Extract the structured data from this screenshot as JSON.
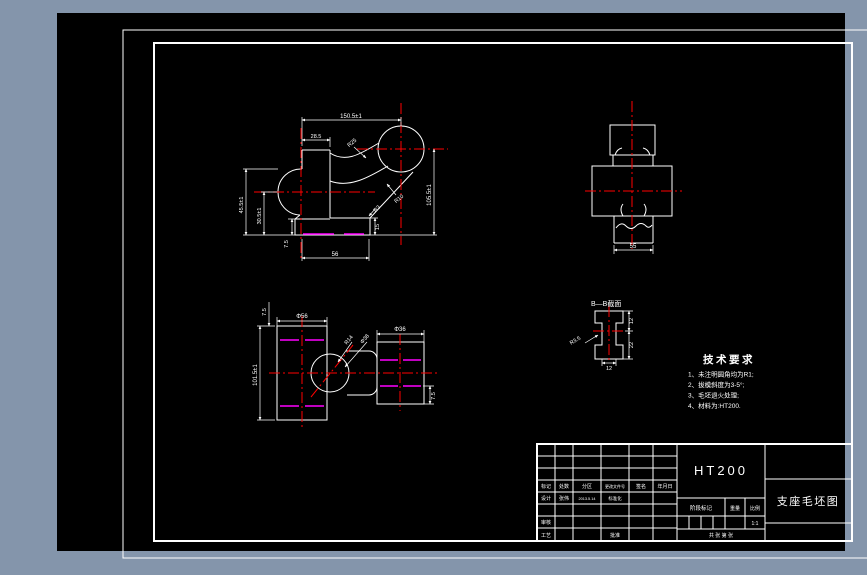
{
  "window": {
    "background_color": "#8495ab",
    "canvas_color": "#000000",
    "line_color": "#ffffff",
    "centerline_color": "#ff0000",
    "parting_line_color": "#ff00ff"
  },
  "front_view": {
    "dim_top": "150.5±1",
    "dim_neck": "28.5",
    "dim_left_outer": "45.5±1",
    "dim_left_inner": "30.5±1",
    "dim_right": "105.5±1",
    "dim_base_width": "56",
    "dim_base_height": "7.5",
    "dim_step": "15",
    "leader_top": "R25",
    "leader_mid": "R10",
    "leader_corner": "R3"
  },
  "side_view": {
    "dim_width": "55"
  },
  "top_view": {
    "dim_left_block": "Φ56",
    "dim_right_block": "Φ36",
    "dim_height": "101.5±1",
    "dim_offset_top": "7.5",
    "dim_offset_bottom": "7.5",
    "leader_radius": "R14",
    "leader_diameter": "Φ38"
  },
  "section_view": {
    "label": "B—B截面",
    "leader": "R3.5",
    "dim_right_top": "12",
    "dim_right_bottom": "22",
    "dim_bottom": "12"
  },
  "tech_requirements": {
    "title": "技术要求",
    "items": [
      "1、未注明圆角均为R1;",
      "2、拔模斜度为3-5°;",
      "3、毛坯退火处理;",
      "4、材料为:HT200."
    ]
  },
  "title_block": {
    "material": "HT200",
    "drawing_title": "支座毛坯图",
    "rev_headers": [
      "标记",
      "处数",
      "分区",
      "更改文件号",
      "签名",
      "年月日"
    ],
    "design_label": "设计",
    "design_name": "张伟",
    "design_date": "2013.5.14",
    "standard_label": "标准化",
    "audit_label": "审核",
    "process_label": "工艺",
    "approve_label": "批准",
    "stage_label": "阶段标记",
    "weight_label": "重量",
    "scale_label": "比例",
    "scale_value": "1:1",
    "sheet_info": "共 张 第 张"
  }
}
